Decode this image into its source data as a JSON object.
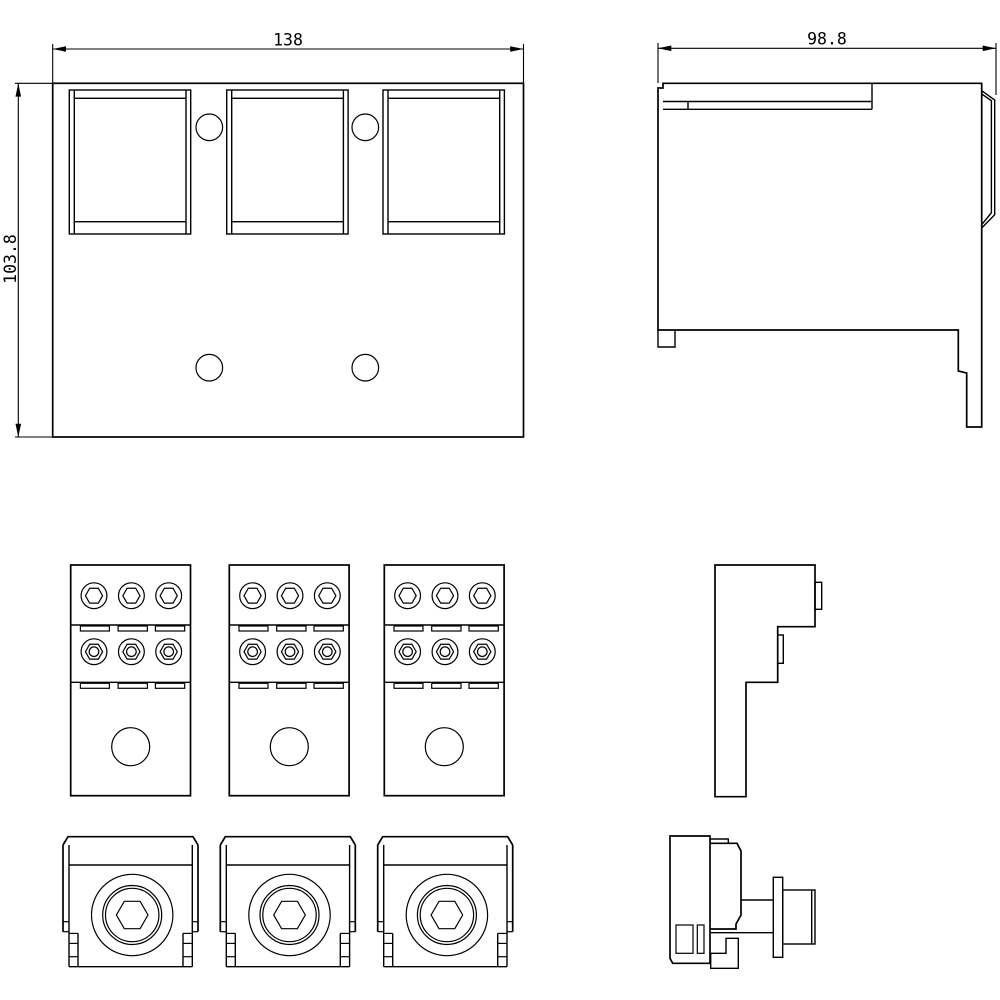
{
  "drawing": {
    "background": "#ffffff",
    "line_color": "#000000",
    "dimensions": {
      "width": "138",
      "height": "103.8",
      "depth": "98.8"
    }
  }
}
